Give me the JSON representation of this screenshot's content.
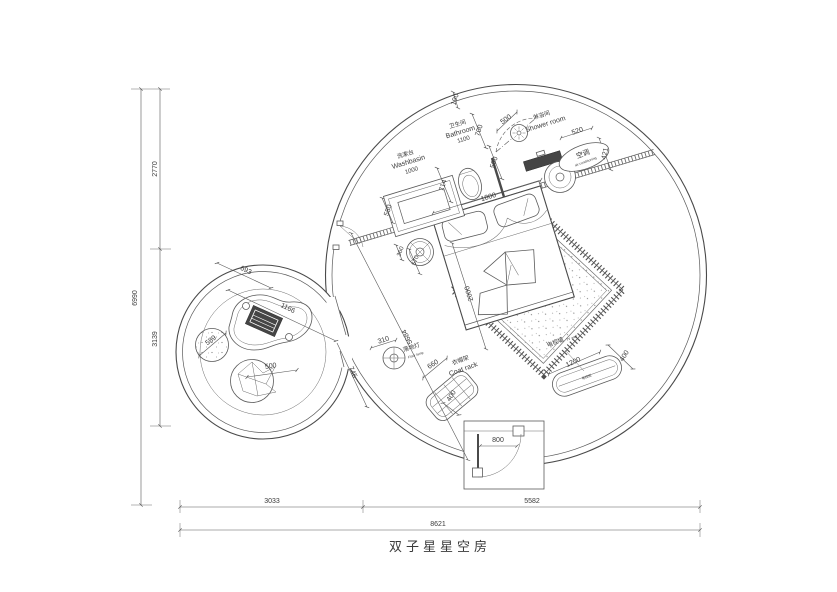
{
  "title": "双子星星空房",
  "colors": {
    "line": "#4a4a4a",
    "text": "#3a3a3a",
    "dark_fill": "#454545",
    "background": "#ffffff"
  },
  "rooms": {
    "washbasin": {
      "cn": "洗漱台",
      "en": "Washbasin",
      "dim": "1000"
    },
    "bathroom": {
      "cn": "卫生间",
      "en": "Bathroom",
      "dim": "1100"
    },
    "shower": {
      "cn": "淋浴间",
      "en": "Shower room"
    },
    "ac": {
      "cn": "空调",
      "en": "air conditioning"
    },
    "floor_lamp": {
      "cn": "落地灯",
      "en": "Floor lamp"
    },
    "coat_rack": {
      "cn": "衣帽架",
      "en": "Coat rack"
    },
    "tv_wall": {
      "cn": "电视墙",
      "en": "TV wall"
    },
    "tv_cabinet": {
      "cn": "电视柜"
    }
  },
  "dims": {
    "gap": "190",
    "partition": "700",
    "shower_door": "500",
    "glass": "590",
    "ac_wall": "520",
    "ac_depth": "421",
    "toilet": "714",
    "basin_depth": "550",
    "bed_width": "1800",
    "bed_length": "2000",
    "side_table": "360",
    "side_gap": "570",
    "diag": "5684",
    "lamp": "310",
    "rack_len": "660",
    "rack_depth": "400",
    "tv_len": "1200",
    "tv_depth": "400",
    "door": "800",
    "small_a": "693",
    "small_b": "1166",
    "small_c": "745",
    "stool": "589",
    "cushion": "500",
    "left_total": "6990",
    "left_upper": "2770",
    "left_lower": "3139",
    "bottom_left": "3033",
    "bottom_right": "5582",
    "bottom_total": "8621"
  }
}
